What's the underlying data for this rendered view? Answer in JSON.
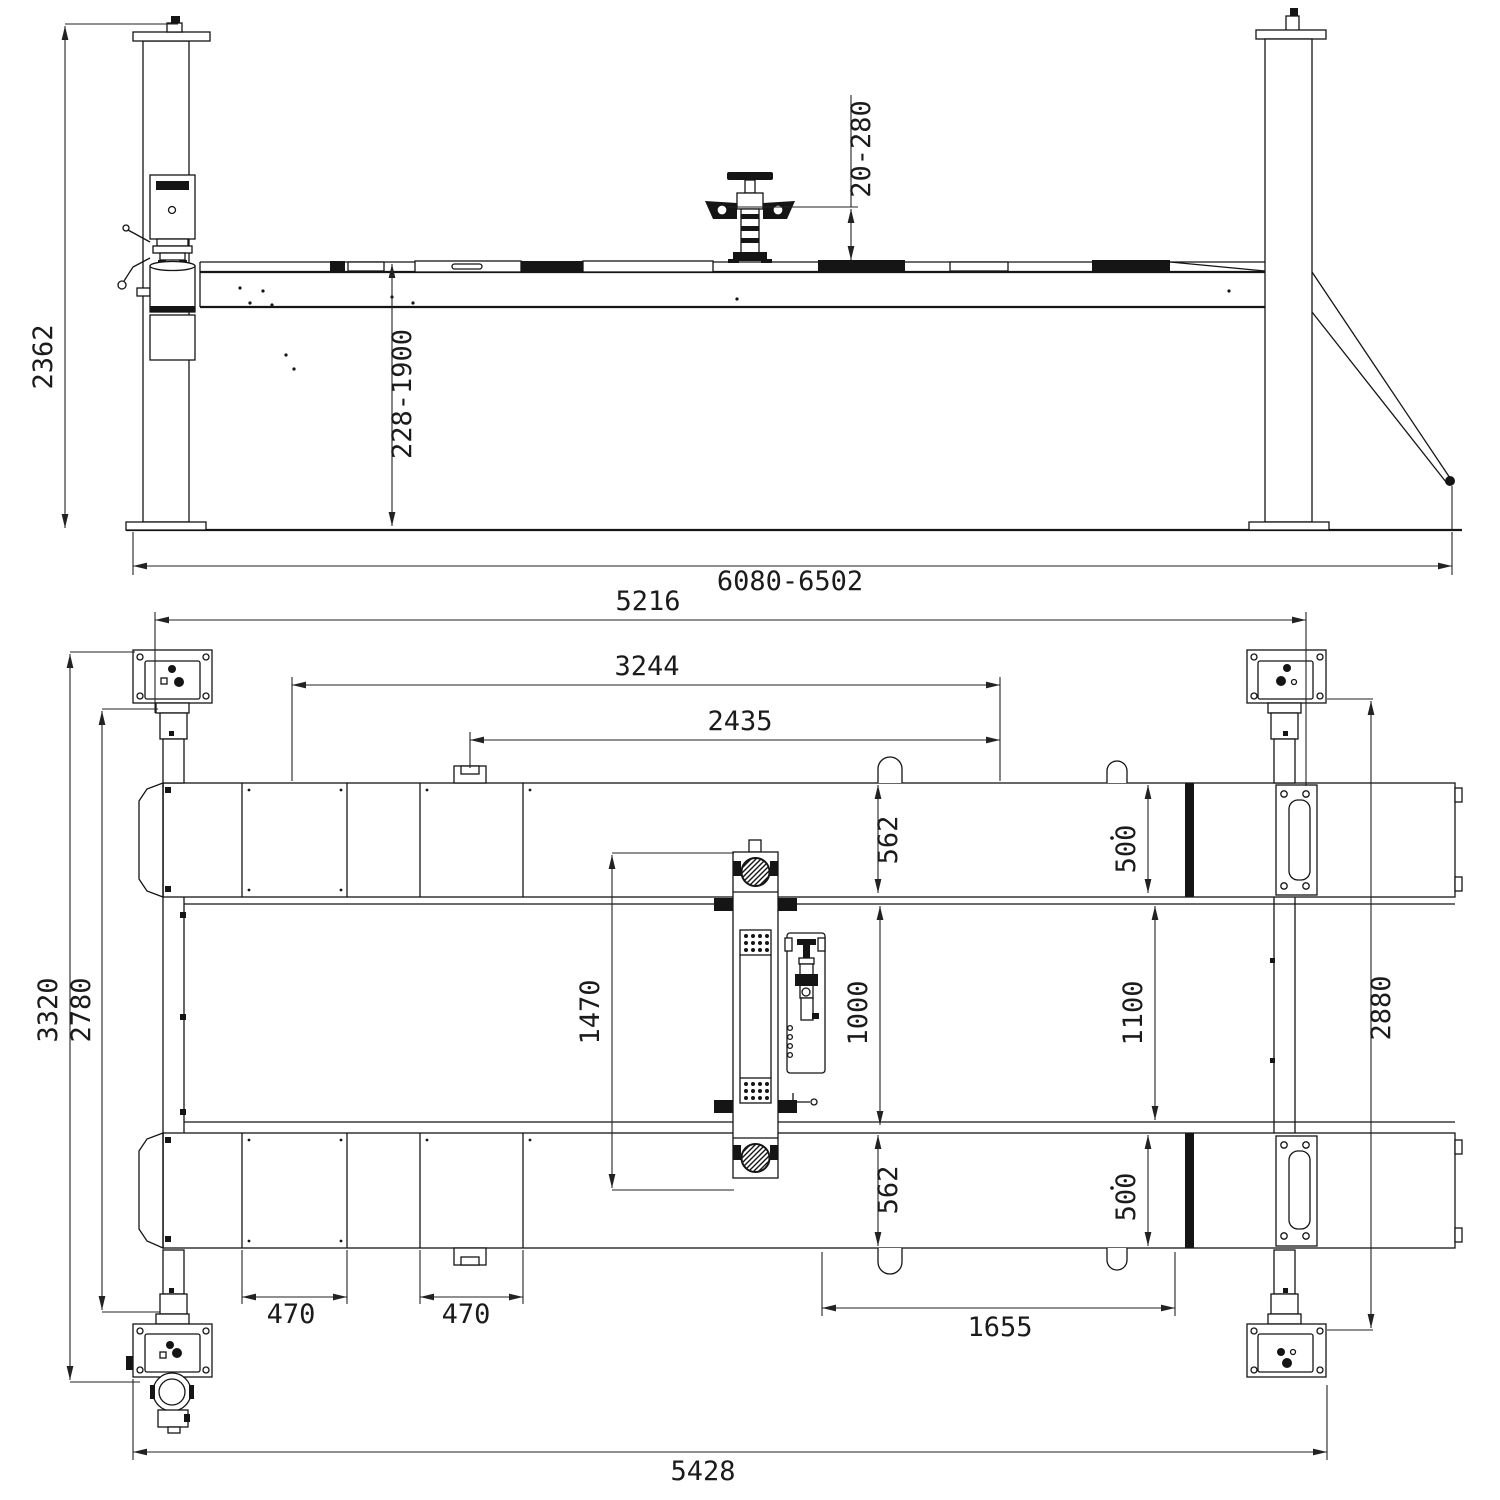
{
  "colors": {
    "ink": "#151515",
    "paper": "#ffffff"
  },
  "dims": {
    "side": {
      "overall_height": "2362",
      "pad_height_range": "20-280",
      "lifting_height_range": "228-1900",
      "overall_length_range": "6080-6502"
    },
    "plan": {
      "post_span": "5216",
      "span_3244": "3244",
      "span_2435": "2435",
      "runway_width_front_left": "562",
      "runway_width_front_right": "500",
      "jack_beam_length": "1470",
      "runway_gap_min": "1000",
      "runway_gap_max": "1100",
      "inner_post_width": "2880",
      "runway_width_rear_left": "562",
      "runway_width_rear_right": "500",
      "segment_front": "470",
      "segment_mid": "470",
      "hook_span": "1655",
      "overall_width": "3320",
      "inner_width": "2780",
      "base_length": "5428"
    }
  }
}
